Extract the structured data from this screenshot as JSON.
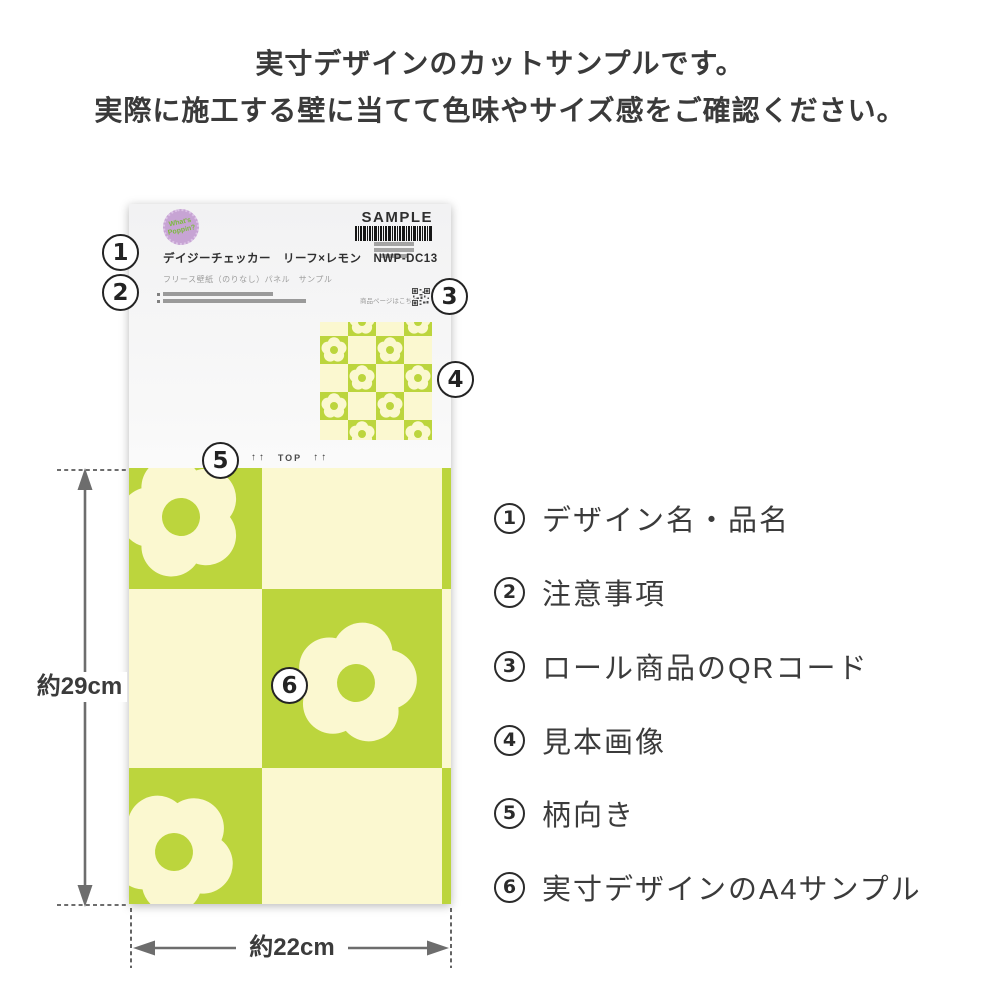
{
  "header": {
    "line1": "実寸デザインのカットサンプルです。",
    "line2": "実際に施工する壁に当てて色味やサイズ感をご確認ください。"
  },
  "card": {
    "logo_line1": "What's",
    "logo_line2": "Poppin?",
    "sample_label": "SAMPLE",
    "product_title": "デイジーチェッカー　リーフ×レモン　NWP-DC13",
    "product_subtitle": "フリース壁紙（のりなし）パネル　サンプル",
    "qr_caption": "商品ページはこちら",
    "orientation_left_arrows": "↑↑",
    "orientation_label": "TOP",
    "orientation_right_arrows": "↑↑"
  },
  "callouts": [
    "1",
    "2",
    "3",
    "4",
    "5",
    "6"
  ],
  "dimensions": {
    "height_label": "約29cm",
    "width_label": "約22cm"
  },
  "legend": [
    {
      "number": "1",
      "label": "デザイン名・品名"
    },
    {
      "number": "2",
      "label": "注意事項"
    },
    {
      "number": "3",
      "label": "ロール商品のQRコード"
    },
    {
      "number": "4",
      "label": "見本画像"
    },
    {
      "number": "5",
      "label": "柄向き"
    },
    {
      "number": "6",
      "label": "実寸デザインのA4サンプル"
    }
  ],
  "colors": {
    "pattern_green": "#bcd53d",
    "pattern_cream": "#fbf8d0",
    "label_background": "#f4f4f4",
    "logo_purple": "#c7a4d4",
    "logo_text_green": "#7cba3e",
    "text_dark": "#3b3b3b"
  }
}
